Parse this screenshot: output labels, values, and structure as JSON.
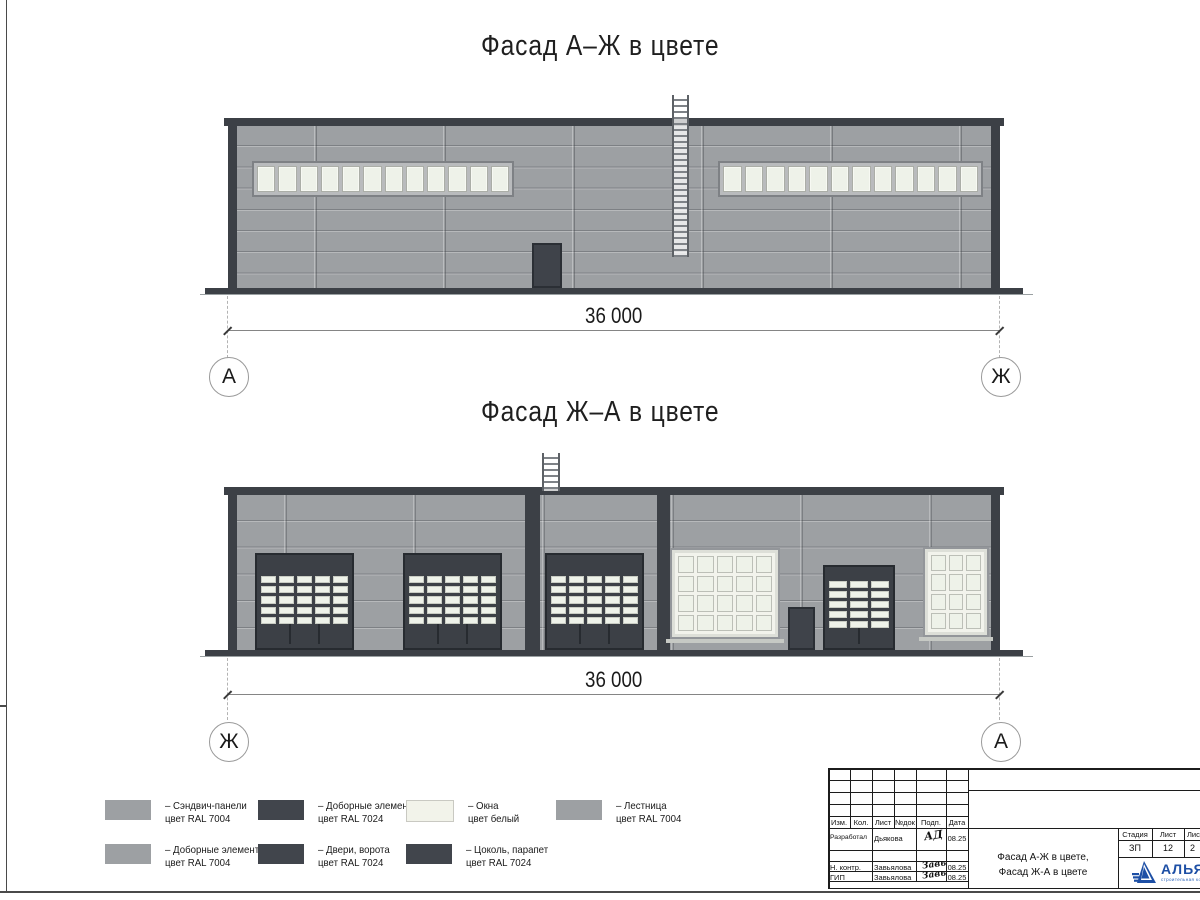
{
  "colors": {
    "wall": "#9da0a3",
    "dark": "#3c4046",
    "pane": "#eef2e9",
    "blue": "#1d4fa5"
  },
  "facade1": {
    "title": "Фасад А–Ж в цвете",
    "dim": "36 000",
    "axis_left": "А",
    "axis_right": "Ж"
  },
  "facade2": {
    "title": "Фасад Ж–А в цвете",
    "dim": "36 000",
    "axis_left": "Ж",
    "axis_right": "А"
  },
  "specs": {
    "ribbon_panes": 12,
    "gate": {
      "rows": 5,
      "cols": 5
    },
    "gate_bottom_sections": 3,
    "small_gate": {
      "rows": 5,
      "cols": 3
    },
    "small_gate_bottom_sections": 2,
    "big_window": {
      "rows": 4,
      "cols": 5
    },
    "small_window": {
      "rows": 4,
      "cols": 3
    }
  },
  "legend": {
    "items": [
      {
        "color": "#9da0a3",
        "line1": "– Сэндвич-панели",
        "line2": "цвет RAL 7004"
      },
      {
        "color": "#41454c",
        "line1": "– Доборные элементы",
        "line2": "цвет RAL 7024"
      },
      {
        "color": "#f2f3ea",
        "line1": "– Окна",
        "line2": "цвет белый"
      },
      {
        "color": "#9da0a3",
        "line1": "– Лестница",
        "line2": "цвет RAL 7004"
      },
      {
        "color": "#9da0a3",
        "line1": "– Доборные элементы",
        "line2": "цвет RAL 7004"
      },
      {
        "color": "#41454c",
        "line1": "– Двери, ворота",
        "line2": "цвет RAL 7024"
      },
      {
        "color": "#41454c",
        "line1": "– Цоколь, парапет",
        "line2": "цвет RAL 7024"
      }
    ]
  },
  "titleblock": {
    "cols": [
      "Изм.",
      "Кол.",
      "Лист",
      "№док",
      "Подп.",
      "Дата"
    ],
    "rows": [
      {
        "role": "Разработал",
        "name": "Дьякова",
        "sign": "АД",
        "date": "08.25"
      },
      {
        "role": "Н. контр.",
        "name": "Завьялова",
        "sign": "Завь",
        "date": "08.25"
      },
      {
        "role": "ГИП",
        "name": "Завьялова",
        "sign": "Завь",
        "date": "08.25"
      }
    ],
    "doc_title1": "Фасад А-Ж в цвете,",
    "doc_title2": "Фасад Ж-А в цвете",
    "stage_label": "Стадия",
    "sheet_label": "Лист",
    "sheets_label": "Лис",
    "stage": "ЗП",
    "sheet": "12",
    "sheets": "2",
    "logo": "АЛЬЯН",
    "logo_sub": "строительная комп"
  }
}
